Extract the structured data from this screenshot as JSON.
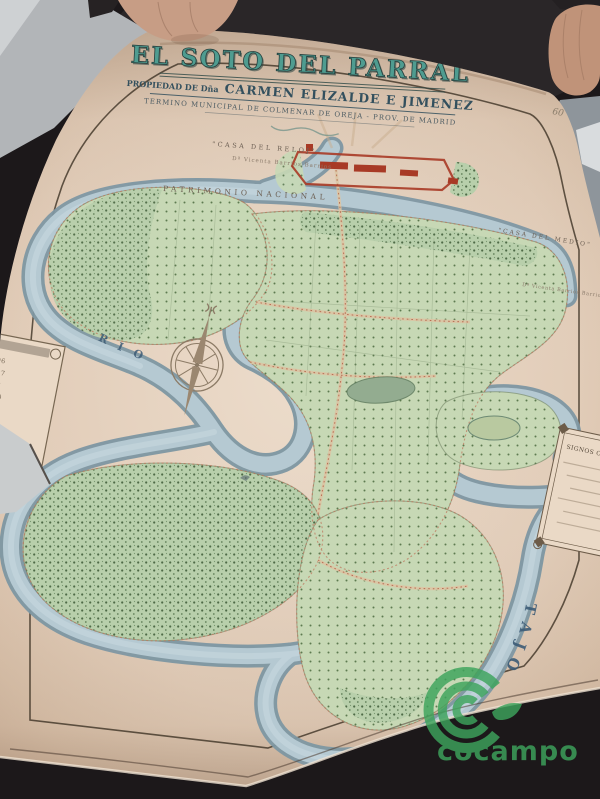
{
  "photo": {
    "watermark": "cocampo"
  },
  "map": {
    "title": "\" EL SOTO DEL PARRAL \"",
    "owner_prefix": "PROPIEDAD DE Dña",
    "owner_name": "CARMEN ELIZALDE E JIMENEZ",
    "subtitle": "TERMINO MUNICIPAL DE COLMENAR DE OREJA - PROV. DE MADRID",
    "pencil_note": "60",
    "labels": {
      "casa_reloj": "\"CASA DEL RELOJ\"",
      "casa_reloj_owner": "Dª Vicenta Barrios Barrios",
      "patrimonio": "PATRIMONIO NACIONAL",
      "casa_medio": "\"CASA DEL MEDIO\"",
      "casa_medio_owner": "Dª Vicenta Barrios Barrios",
      "rio": "RIO",
      "tajo": "TAJO"
    },
    "left_table": {
      "rows": [
        "7496",
        "3807",
        "5402",
        "1970",
        "1479",
        "1690",
        "2031",
        "1034"
      ]
    },
    "right_legend": {
      "title": "SIGNOS CONVENCIONALES"
    }
  },
  "colors": {
    "paper": "#e7d5c3",
    "title_teal": "#4f9c90",
    "ink_navy": "#33505e",
    "river": "#b5c9d2",
    "field_green": "#c7d8b5",
    "building_red": "#a83a26",
    "watermark_green": "#3da45c"
  }
}
